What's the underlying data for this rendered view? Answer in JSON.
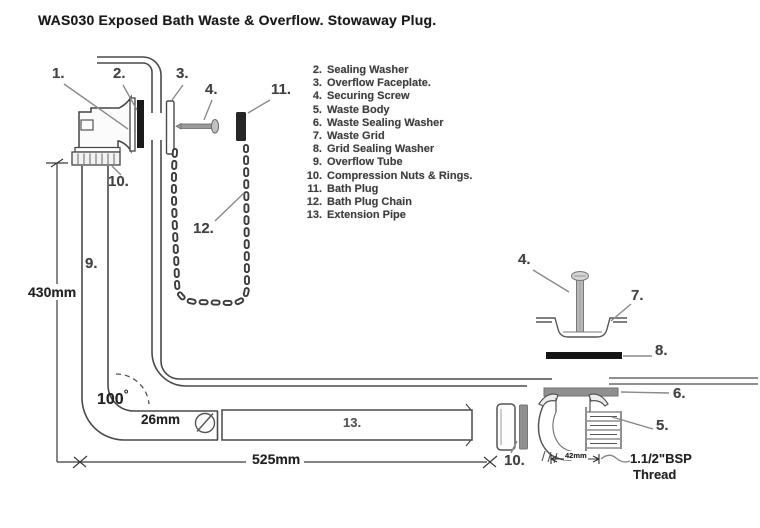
{
  "title": "WAS030 Exposed Bath Waste & Overflow. Stowaway Plug.",
  "parts_list": [
    {
      "num": "2.",
      "name": "Sealing Washer"
    },
    {
      "num": "3.",
      "name": "Overflow Faceplate."
    },
    {
      "num": "4.",
      "name": "Securing Screw"
    },
    {
      "num": "5.",
      "name": "Waste Body"
    },
    {
      "num": "6.",
      "name": "Waste Sealing Washer"
    },
    {
      "num": "7.",
      "name": "Waste Grid"
    },
    {
      "num": "8.",
      "name": "Grid Sealing Washer"
    },
    {
      "num": "9.",
      "name": "Overflow Tube"
    },
    {
      "num": "10.",
      "name": "Compression Nuts & Rings."
    },
    {
      "num": "11.",
      "name": "Bath Plug"
    },
    {
      "num": "12.",
      "name": "Bath Plug Chain"
    },
    {
      "num": "13.",
      "name": "Extension Pipe"
    }
  ],
  "callouts": {
    "overflow_elbow": "1.",
    "sealing_washer": "2.",
    "overflow_faceplate": "3.",
    "securing_screw": "4.",
    "waste_body": "5.",
    "waste_sealing_washer": "6.",
    "waste_grid": "7.",
    "grid_sealing_washer": "8.",
    "overflow_tube": "9.",
    "compression_nuts": "10.",
    "bath_plug": "11.",
    "bath_plug_chain": "12.",
    "extension_pipe": "13."
  },
  "dimensions": {
    "tube_height": "430mm",
    "pipe_length": "525mm",
    "tube_diameter": "26mm",
    "bend_angle": "100",
    "degree_symbol": "°",
    "outlet_width": "42mm",
    "thread_line1": "1.1/2\"BSP",
    "thread_line2": "Thread"
  }
}
